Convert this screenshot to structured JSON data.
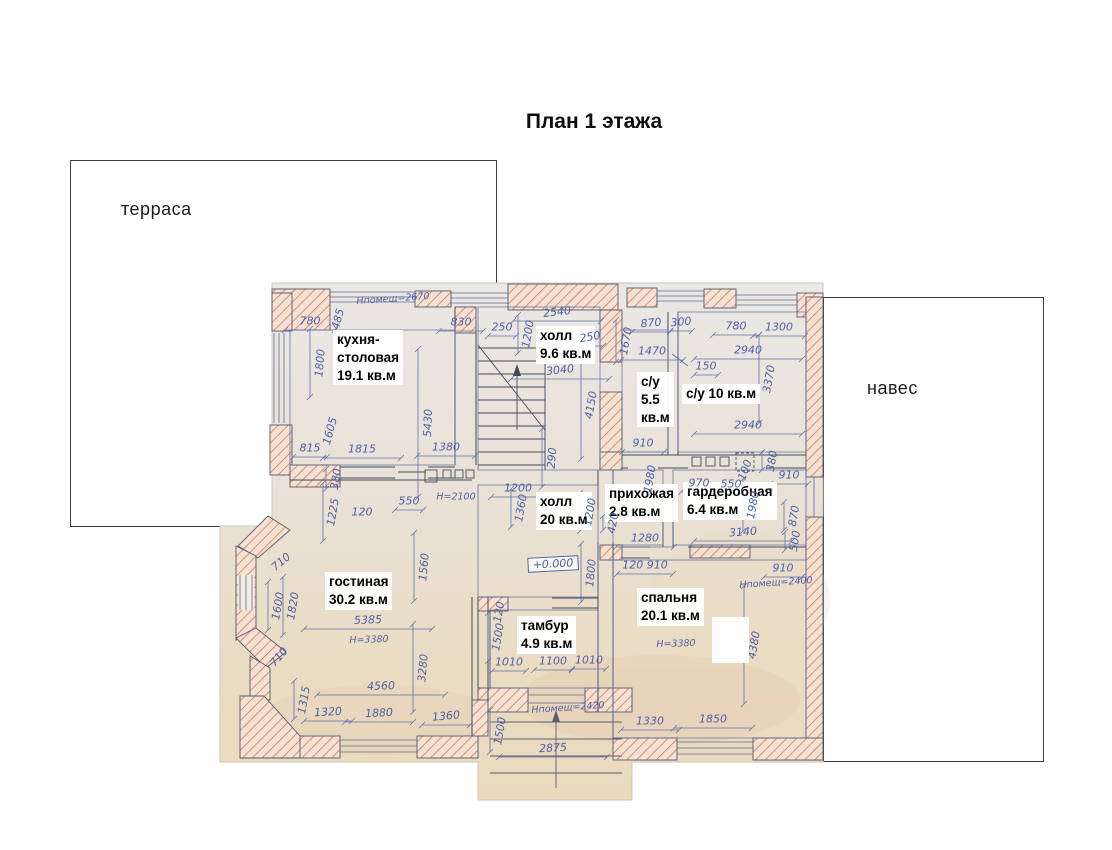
{
  "title": "План 1 этажа",
  "outside": {
    "terrace_label": "терраса",
    "canopy_label": "навес"
  },
  "colors": {
    "paper_top": "#eae6e2",
    "paper_bottom": "#ead9bd",
    "wall_fill": "#f6e0d1",
    "wall_hatch": "#bb7a5c",
    "ink_blue": "#4f5fa8",
    "line_blue": "#6273a8",
    "wall_outline": "#54596a",
    "label_black": "#000000"
  },
  "plan": {
    "rooms": [
      {
        "id": "kitchen",
        "lines": [
          "кухня-",
          "столовая",
          "19.1 кв.м"
        ],
        "x": 333,
        "y": 330
      },
      {
        "id": "hall-upper",
        "lines": [
          "холл",
          "9.6 кв.м"
        ],
        "x": 536,
        "y": 326
      },
      {
        "id": "bathroom-small",
        "lines": [
          "с/у",
          "5.5",
          "кв.м"
        ],
        "x": 637,
        "y": 372
      },
      {
        "id": "bathroom-large",
        "lines": [
          "с/у 10 кв.м"
        ],
        "x": 682,
        "y": 384
      },
      {
        "id": "entry-hall",
        "lines": [
          "прихожая",
          "2.8 кв.м"
        ],
        "x": 605,
        "y": 484
      },
      {
        "id": "wardrobe",
        "lines": [
          "гардеробная",
          "6.4 кв.м"
        ],
        "x": 683,
        "y": 482
      },
      {
        "id": "hall-main",
        "lines": [
          "холл",
          "20 кв.м"
        ],
        "x": 536,
        "y": 492
      },
      {
        "id": "living-room",
        "lines": [
          "гостиная",
          "30.2 кв.м"
        ],
        "x": 325,
        "y": 572
      },
      {
        "id": "vestibule",
        "lines": [
          "тамбур",
          "4.9 кв.м"
        ],
        "x": 517,
        "y": 616
      },
      {
        "id": "bedroom",
        "lines": [
          "спальня",
          "20.1 кв.м"
        ],
        "x": 637,
        "y": 588
      }
    ],
    "dimensions": [
      {
        "t": "Нпомещ=2670",
        "x": 393,
        "y": 299,
        "r": -4,
        "l": 0
      },
      {
        "t": "780",
        "x": 310,
        "y": 321,
        "r": 0,
        "l": 50
      },
      {
        "t": "485",
        "x": 338,
        "y": 319,
        "r": -75,
        "l": 0
      },
      {
        "t": "830",
        "x": 461,
        "y": 322,
        "r": 0,
        "l": 44
      },
      {
        "t": "250",
        "x": 502,
        "y": 327,
        "r": 0,
        "l": 28
      },
      {
        "t": "1200",
        "x": 528,
        "y": 334,
        "r": -80,
        "l": 38
      },
      {
        "t": "2540",
        "x": 557,
        "y": 312,
        "r": -6,
        "l": 88
      },
      {
        "t": "250",
        "x": 590,
        "y": 337,
        "r": -10,
        "l": 26
      },
      {
        "t": "870",
        "x": 651,
        "y": 323,
        "r": -5,
        "l": 38
      },
      {
        "t": "300",
        "x": 681,
        "y": 322,
        "r": -5,
        "l": 22
      },
      {
        "t": "780",
        "x": 736,
        "y": 326,
        "r": 0,
        "l": 46
      },
      {
        "t": "1300",
        "x": 779,
        "y": 327,
        "r": 0,
        "l": 52
      },
      {
        "t": "1670",
        "x": 626,
        "y": 341,
        "r": -80,
        "l": 42
      },
      {
        "t": "1470",
        "x": 652,
        "y": 351,
        "r": 0,
        "l": 62
      },
      {
        "t": "2940",
        "x": 748,
        "y": 350,
        "r": 0,
        "l": 108
      },
      {
        "t": "150",
        "x": 706,
        "y": 366,
        "r": 0,
        "l": 24
      },
      {
        "t": "3370",
        "x": 769,
        "y": 379,
        "r": -80,
        "l": 88
      },
      {
        "t": "1800",
        "x": 320,
        "y": 363,
        "r": -85,
        "l": 68
      },
      {
        "t": "3040",
        "x": 560,
        "y": 370,
        "r": -6,
        "l": 98
      },
      {
        "t": "4150",
        "x": 591,
        "y": 405,
        "r": -80,
        "l": 108
      },
      {
        "t": "5430",
        "x": 428,
        "y": 423,
        "r": -88,
        "l": 148
      },
      {
        "t": "290",
        "x": 552,
        "y": 458,
        "r": -85,
        "l": 58
      },
      {
        "t": "2940",
        "x": 748,
        "y": 425,
        "r": 0,
        "l": 108
      },
      {
        "t": "910",
        "x": 643,
        "y": 443,
        "r": 0,
        "l": 42
      },
      {
        "t": "815",
        "x": 310,
        "y": 448,
        "r": 0,
        "l": 34
      },
      {
        "t": "1605",
        "x": 330,
        "y": 431,
        "r": -75,
        "l": 0
      },
      {
        "t": "1815",
        "x": 362,
        "y": 449,
        "r": 0,
        "l": 78
      },
      {
        "t": "1380",
        "x": 446,
        "y": 447,
        "r": 0,
        "l": 58
      },
      {
        "t": "380",
        "x": 336,
        "y": 479,
        "r": -80,
        "l": 20
      },
      {
        "t": "1225",
        "x": 333,
        "y": 512,
        "r": -80,
        "l": 58
      },
      {
        "t": "120",
        "x": 362,
        "y": 512,
        "r": 0,
        "l": 0
      },
      {
        "t": "550",
        "x": 409,
        "y": 501,
        "r": 0,
        "l": 28
      },
      {
        "t": "H=2100",
        "x": 456,
        "y": 497,
        "r": 0,
        "l": 0
      },
      {
        "t": "970",
        "x": 699,
        "y": 483,
        "r": 0,
        "l": 36
      },
      {
        "t": "550",
        "x": 731,
        "y": 484,
        "r": 0,
        "l": 26
      },
      {
        "t": "100",
        "x": 745,
        "y": 470,
        "r": -70,
        "l": 0
      },
      {
        "t": "380",
        "x": 772,
        "y": 461,
        "r": -80,
        "l": 18
      },
      {
        "t": "910",
        "x": 789,
        "y": 475,
        "r": 0,
        "l": 38
      },
      {
        "t": "1980",
        "x": 650,
        "y": 479,
        "r": -80,
        "l": 0
      },
      {
        "t": "1980",
        "x": 753,
        "y": 505,
        "r": -80,
        "l": 52
      },
      {
        "t": "1200",
        "x": 590,
        "y": 512,
        "r": -80,
        "l": 38
      },
      {
        "t": "420",
        "x": 613,
        "y": 523,
        "r": -80,
        "l": 14
      },
      {
        "t": "1280",
        "x": 645,
        "y": 538,
        "r": 0,
        "l": 58
      },
      {
        "t": "3140",
        "x": 743,
        "y": 532,
        "r": -4,
        "l": 98
      },
      {
        "t": "870",
        "x": 794,
        "y": 516,
        "r": -80,
        "l": 28
      },
      {
        "t": "500",
        "x": 795,
        "y": 541,
        "r": -80,
        "l": 18
      },
      {
        "t": "120 910",
        "x": 645,
        "y": 565,
        "r": 0,
        "l": 56
      },
      {
        "t": "910",
        "x": 783,
        "y": 568,
        "r": 0,
        "l": 38
      },
      {
        "t": "Нпомещ=2400",
        "x": 776,
        "y": 583,
        "r": -4,
        "l": 0
      },
      {
        "t": "1800",
        "x": 591,
        "y": 573,
        "r": -85,
        "l": 58
      },
      {
        "t": "1560",
        "x": 424,
        "y": 567,
        "r": -85,
        "l": 68
      },
      {
        "t": "1200",
        "x": 518,
        "y": 488,
        "r": 0,
        "l": 54
      },
      {
        "t": "1360",
        "x": 521,
        "y": 508,
        "r": -80,
        "l": 38
      },
      {
        "t": "+0.000",
        "x": 553,
        "y": 564,
        "r": -3,
        "l": 0,
        "b": true
      },
      {
        "t": "710",
        "x": 281,
        "y": 562,
        "r": -40,
        "l": 0
      },
      {
        "t": "1600",
        "x": 278,
        "y": 606,
        "r": -80,
        "l": 48
      },
      {
        "t": "1820",
        "x": 293,
        "y": 606,
        "r": -80,
        "l": 58
      },
      {
        "t": "710",
        "x": 279,
        "y": 657,
        "r": -50,
        "l": 0
      },
      {
        "t": "5385",
        "x": 368,
        "y": 620,
        "r": -2,
        "l": 128
      },
      {
        "t": "H=3380",
        "x": 369,
        "y": 640,
        "r": -2,
        "l": 0
      },
      {
        "t": "3280",
        "x": 423,
        "y": 668,
        "r": -85,
        "l": 88
      },
      {
        "t": "4560",
        "x": 381,
        "y": 686,
        "r": -2,
        "l": 128
      },
      {
        "t": "1315",
        "x": 304,
        "y": 700,
        "r": -80,
        "l": 38
      },
      {
        "t": "1320",
        "x": 328,
        "y": 712,
        "r": -3,
        "l": 48
      },
      {
        "t": "1880",
        "x": 379,
        "y": 713,
        "r": -3,
        "l": 68
      },
      {
        "t": "1360",
        "x": 446,
        "y": 716,
        "r": -5,
        "l": 48
      },
      {
        "t": "1500",
        "x": 498,
        "y": 637,
        "r": -80,
        "l": 48
      },
      {
        "t": "120",
        "x": 499,
        "y": 612,
        "r": -80,
        "l": 0
      },
      {
        "t": "1010",
        "x": 509,
        "y": 662,
        "r": 0,
        "l": 34
      },
      {
        "t": "1100",
        "x": 553,
        "y": 661,
        "r": 0,
        "l": 38
      },
      {
        "t": "1010",
        "x": 589,
        "y": 660,
        "r": 0,
        "l": 34
      },
      {
        "t": "Нпомещ=2420",
        "x": 568,
        "y": 708,
        "r": -4,
        "l": 0
      },
      {
        "t": "1500",
        "x": 500,
        "y": 731,
        "r": -80,
        "l": 42
      },
      {
        "t": "2875",
        "x": 553,
        "y": 748,
        "r": -3,
        "l": 108
      },
      {
        "t": "1330",
        "x": 650,
        "y": 721,
        "r": 0,
        "l": 58
      },
      {
        "t": "1850",
        "x": 713,
        "y": 719,
        "r": 0,
        "l": 78
      },
      {
        "t": "4380",
        "x": 754,
        "y": 645,
        "r": -80,
        "l": 118
      },
      {
        "t": "Н=3380",
        "x": 676,
        "y": 644,
        "r": -2,
        "l": 0
      }
    ]
  }
}
